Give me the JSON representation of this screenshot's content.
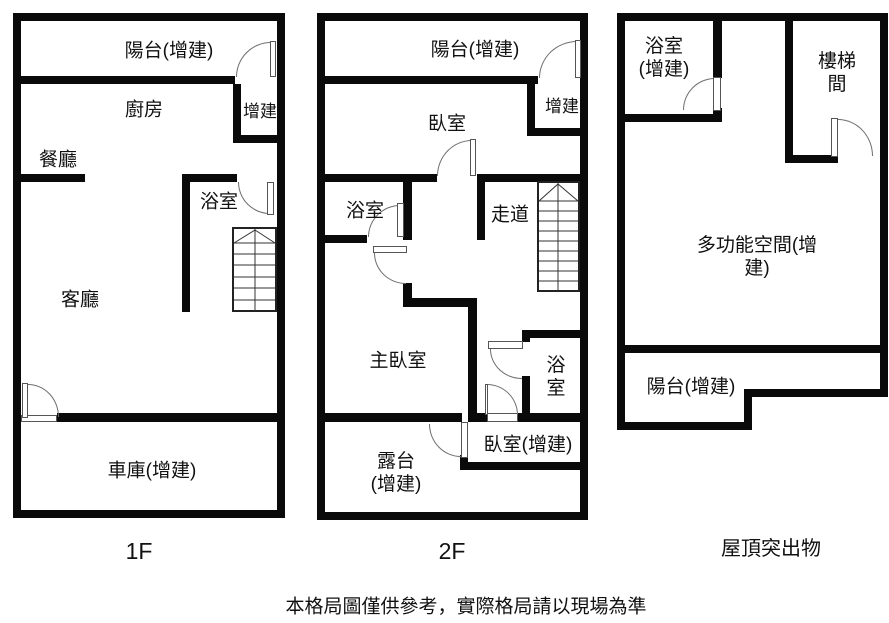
{
  "caption": "本格局圖僅供參考，實際格局請以現場為準",
  "floors": {
    "f1": {
      "name": "1F",
      "rooms": {
        "balcony": "陽台(增建)",
        "kitchen": "廚房",
        "addition": "增建",
        "dining": "餐廳",
        "bath": "浴室",
        "living": "客廳",
        "garage": "車庫(增建)"
      }
    },
    "f2": {
      "name": "2F",
      "rooms": {
        "balcony": "陽台(增建)",
        "bedroom": "臥室",
        "addition": "增建",
        "bath": "浴室",
        "corridor": "走道",
        "master": "主臥室",
        "bath2": "浴\n室",
        "terrace": "露台\n(增建)",
        "bedroom2": "臥室(增建)"
      }
    },
    "roof": {
      "name": "屋頂突出物",
      "rooms": {
        "bath": "浴室\n(增建)",
        "stairwell": "樓梯間",
        "multi": "多功能空間(增建)",
        "balcony": "陽台(增建)"
      }
    }
  },
  "colors": {
    "wall": "#0a0a0a",
    "line": "#222222",
    "door_arc": "#6e6e6e",
    "text": "#111111",
    "background": "#ffffff"
  }
}
